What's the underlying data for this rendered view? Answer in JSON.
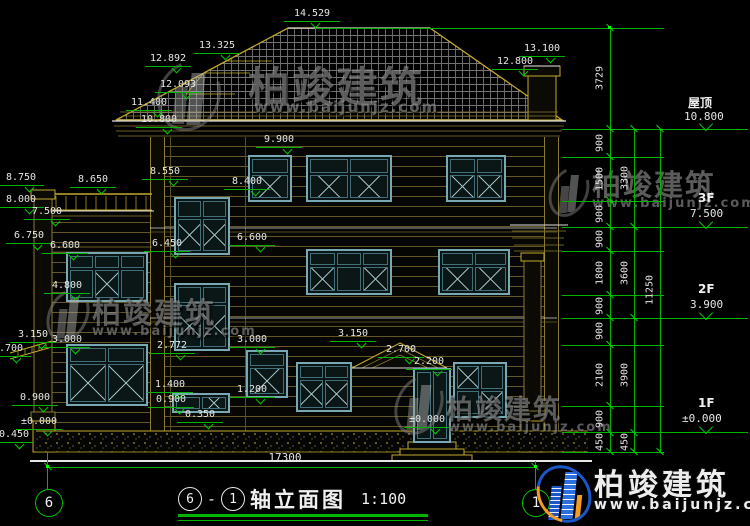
{
  "watermark": {
    "brand": "柏竣建筑",
    "url": "www.baijunjz.com"
  },
  "title": {
    "axis_from": "6",
    "separator": "-",
    "axis_to": "1",
    "name": "轴立面图",
    "scale": "1:100"
  },
  "axis_bubbles": {
    "left": "6",
    "right": "1"
  },
  "levels": [
    {
      "label": "屋顶",
      "value": "10.800"
    },
    {
      "label": "3F",
      "value": "7.500"
    },
    {
      "label": "2F",
      "value": "3.900"
    },
    {
      "label": "1F",
      "value": "±0.000"
    }
  ],
  "markers": [
    "14.529",
    "13.325",
    "12.892",
    "12.093",
    "11.400",
    "10.800",
    "13.100",
    "12.800",
    "9.900",
    "8.550",
    "8.400",
    "8.750",
    "8.650",
    "8.000",
    "7.500",
    "6.750",
    "6.600",
    "6.450",
    "6.600",
    "4.800",
    "2.700",
    "3.150",
    "3.000",
    "2.772",
    "3.150",
    "2.700",
    "2.200",
    "1.400",
    "1.200",
    "0.900",
    "0.350",
    "±0.000",
    "±0.000",
    "-0.450",
    "3.000",
    "0.900"
  ],
  "dims": {
    "roof_rise": "3729",
    "chain_inner": [
      "900",
      "1500",
      "900",
      "900",
      "1800",
      "900",
      "900",
      "2100",
      "900",
      "450"
    ],
    "chain_mid": [
      "3300",
      "3600",
      "3900",
      "450"
    ],
    "chain_outer": [
      "11250"
    ],
    "total_width": "17300"
  },
  "colors": {
    "dimension_green": "#00b400",
    "outline_yellow": "#c2a92c",
    "window_teal": "#78a8b2",
    "text_white": "#e6e6e6",
    "logo_blue": "#1c57c9",
    "logo_orange": "#f59a23"
  }
}
